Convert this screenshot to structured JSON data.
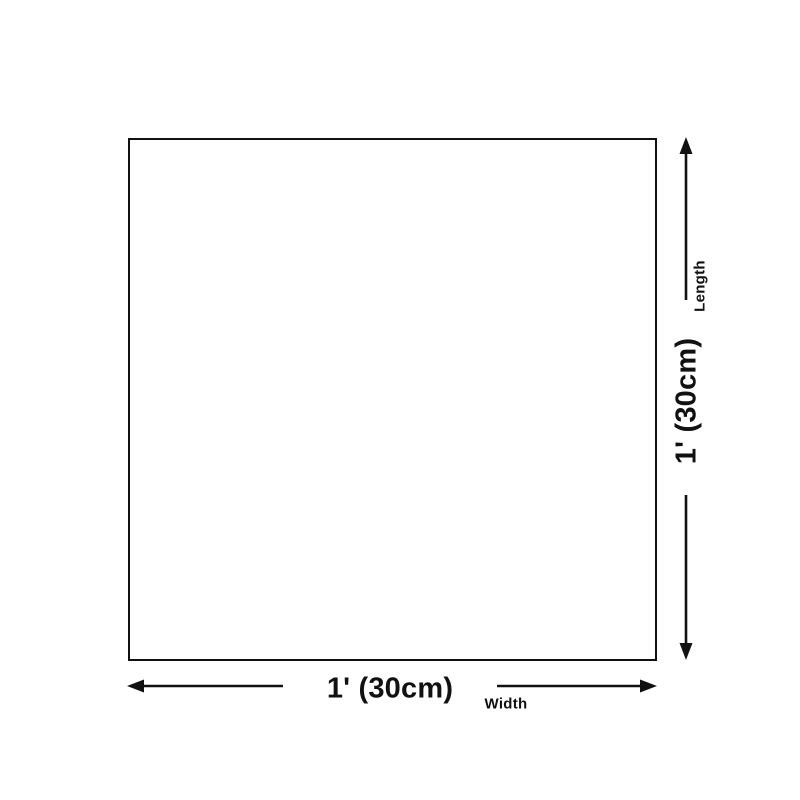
{
  "colors": {
    "line": "#111111",
    "background": "#ffffff"
  },
  "width_dimension": {
    "value": "1' (30cm)",
    "label": "Width"
  },
  "length_dimension": {
    "value": "1' (30cm)",
    "label": "Length"
  }
}
